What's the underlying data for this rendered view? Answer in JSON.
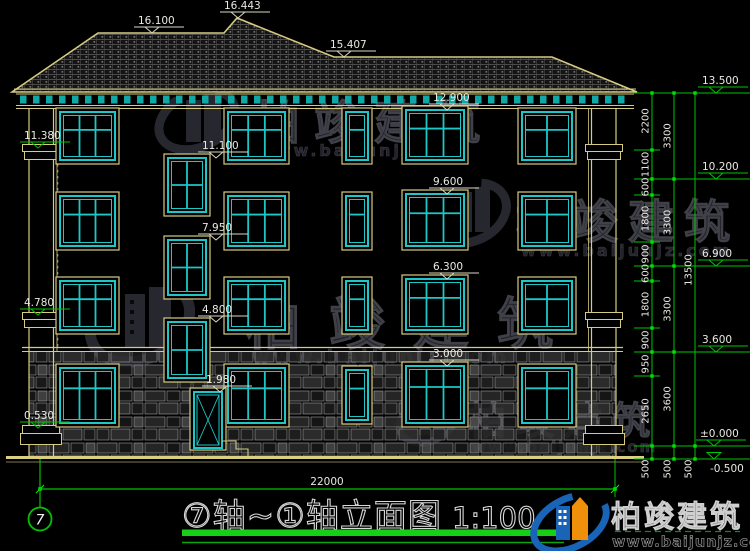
{
  "drawing": {
    "title": "⑦轴~①轴立面图",
    "scale": "1:100",
    "axis_bubble": "7",
    "overall_width_dim": "22000"
  },
  "roof_markers": [
    "16.100",
    "16.443",
    "15.407"
  ],
  "left_markers": [
    "11.380",
    "4.780",
    "0.530"
  ],
  "stair_markers": [
    "11.100",
    "7.950",
    "4.800",
    "1.980"
  ],
  "center_markers": [
    "12.900",
    "9.600",
    "6.300",
    "3.000"
  ],
  "right_markers": [
    "13.500",
    "10.200",
    "6.900",
    "3.600",
    "±0.000",
    "-0.500"
  ],
  "dim_chain_inner": [
    "2200",
    "1100",
    "600",
    "1800",
    "900",
    "600",
    "1800",
    "900",
    "950",
    "2650",
    "500"
  ],
  "dim_chain_floors": [
    "3300",
    "3300",
    "3300",
    "3600",
    "500"
  ],
  "dim_chain_total": [
    "13500",
    "500"
  ],
  "watermark": {
    "brand": "柏竣建筑",
    "url": "www.baijunjz.com"
  },
  "footer_logo": {
    "brand": "柏竣建筑",
    "url": "www.baijunjz.com"
  },
  "colors": {
    "window_cyan": "#1dc7c7",
    "trim_yellow": "#d6cb80",
    "dim_green": "#00c400",
    "text": "#e9e9e3"
  }
}
